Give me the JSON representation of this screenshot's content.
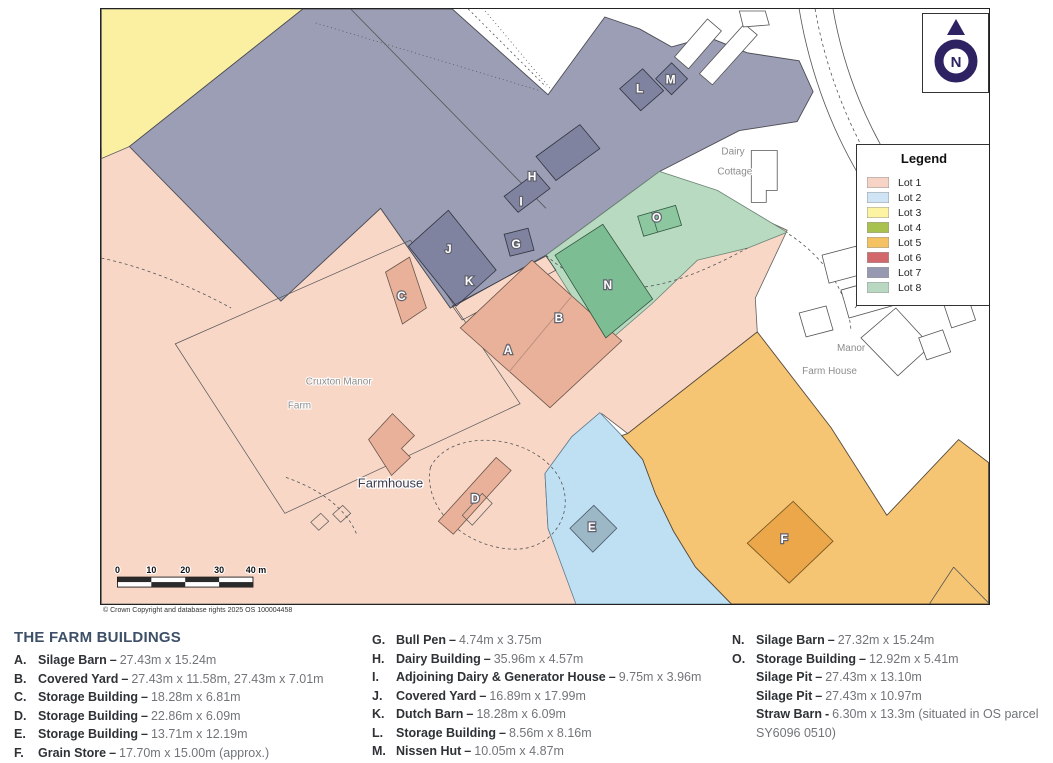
{
  "map": {
    "copyright": "© Crown Copyright and database rights 2025 OS 100004458",
    "north": {
      "label": "N",
      "color": "#2e2262"
    },
    "legend": {
      "title": "Legend",
      "items": [
        {
          "label": "Lot 1",
          "color": "#f6d3c5"
        },
        {
          "label": "Lot 2",
          "color": "#cfe5f5"
        },
        {
          "label": "Lot 3",
          "color": "#fcf3a3"
        },
        {
          "label": "Lot 4",
          "color": "#a9c14e"
        },
        {
          "label": "Lot 5",
          "color": "#f4c163"
        },
        {
          "label": "Lot 6",
          "color": "#d2686c"
        },
        {
          "label": "Lot 7",
          "color": "#9799b0"
        },
        {
          "label": "Lot 8",
          "color": "#b9d8c1"
        }
      ]
    },
    "lot_colors": {
      "lot1": "#f8d7c7",
      "lot2": "#bfdff2",
      "lot3": "#fbf0a2",
      "lot5": "#f5c573",
      "lot7": "#9b9eb4",
      "lot8": "#b7dac0"
    },
    "scale_bar": {
      "ticks": [
        "0",
        "10",
        "20",
        "30",
        "40 m"
      ]
    },
    "letters": {
      "A": "A",
      "B": "B",
      "C": "C",
      "D": "D",
      "E": "E",
      "F": "F",
      "G": "G",
      "H": "H",
      "I": "I",
      "J": "J",
      "K": "K",
      "L": "L",
      "M": "M",
      "N": "N",
      "O": "O"
    },
    "place_labels": {
      "cruxton_line1": "Cruxton Manor",
      "cruxton_line2": "Farm",
      "farmhouse": "Farmhouse",
      "dairy_line1": "Dairy",
      "dairy_line2": "Cottage",
      "manor_line1": "Manor",
      "manor_line2": "Farm House"
    }
  },
  "buildings_list": {
    "title": "THE FARM BUILDINGS",
    "column1": [
      {
        "key": "A.",
        "name": "Silage Barn",
        "sep": "–",
        "dims": "27.43m x 15.24m"
      },
      {
        "key": "B.",
        "name": "Covered Yard",
        "sep": "–",
        "dims": "27.43m x 11.58m, 27.43m x 7.01m"
      },
      {
        "key": "C.",
        "name": "Storage Building",
        "sep": "–",
        "dims": "18.28m x 6.81m"
      },
      {
        "key": "D.",
        "name": "Storage Building",
        "sep": "–",
        "dims": "22.86m x 6.09m"
      },
      {
        "key": "E.",
        "name": "Storage Building",
        "sep": "–",
        "dims": "13.71m x 12.19m"
      },
      {
        "key": "F.",
        "name": "Grain Store",
        "sep": "–",
        "dims": "17.70m x 15.00m (approx.)"
      }
    ],
    "column2": [
      {
        "key": "G.",
        "name": "Bull Pen",
        "sep": "–",
        "dims": "4.74m x 3.75m"
      },
      {
        "key": "H.",
        "name": "Dairy Building",
        "sep": "–",
        "dims": "35.96m x 4.57m"
      },
      {
        "key": "I.",
        "name": "Adjoining Dairy & Generator House",
        "sep": "–",
        "dims": "9.75m x 3.96m"
      },
      {
        "key": "J.",
        "name": "Covered Yard",
        "sep": "–",
        "dims": "16.89m x 17.99m"
      },
      {
        "key": "K.",
        "name": "Dutch Barn",
        "sep": "–",
        "dims": "18.28m x 6.09m"
      },
      {
        "key": "L.",
        "name": "Storage Building",
        "sep": "–",
        "dims": "8.56m x 8.16m"
      },
      {
        "key": "M.",
        "name": "Nissen Hut",
        "sep": "–",
        "dims": "10.05m x 4.87m"
      }
    ],
    "column3": [
      {
        "key": "N.",
        "name": "Silage Barn",
        "sep": "–",
        "dims": "27.32m x 15.24m"
      },
      {
        "key": "O.",
        "name": "Storage Building",
        "sep": "–",
        "dims": "12.92m x 5.41m"
      },
      {
        "key": "",
        "name": "Silage Pit",
        "sep": "–",
        "dims": "27.43m x 13.10m"
      },
      {
        "key": "",
        "name": "Silage Pit",
        "sep": "–",
        "dims": "27.43m x 10.97m"
      },
      {
        "key": "",
        "name": "Straw Barn",
        "sep": "-",
        "dims": "6.30m x 13.3m (situated in OS parcel SY6096 0510)"
      }
    ]
  }
}
